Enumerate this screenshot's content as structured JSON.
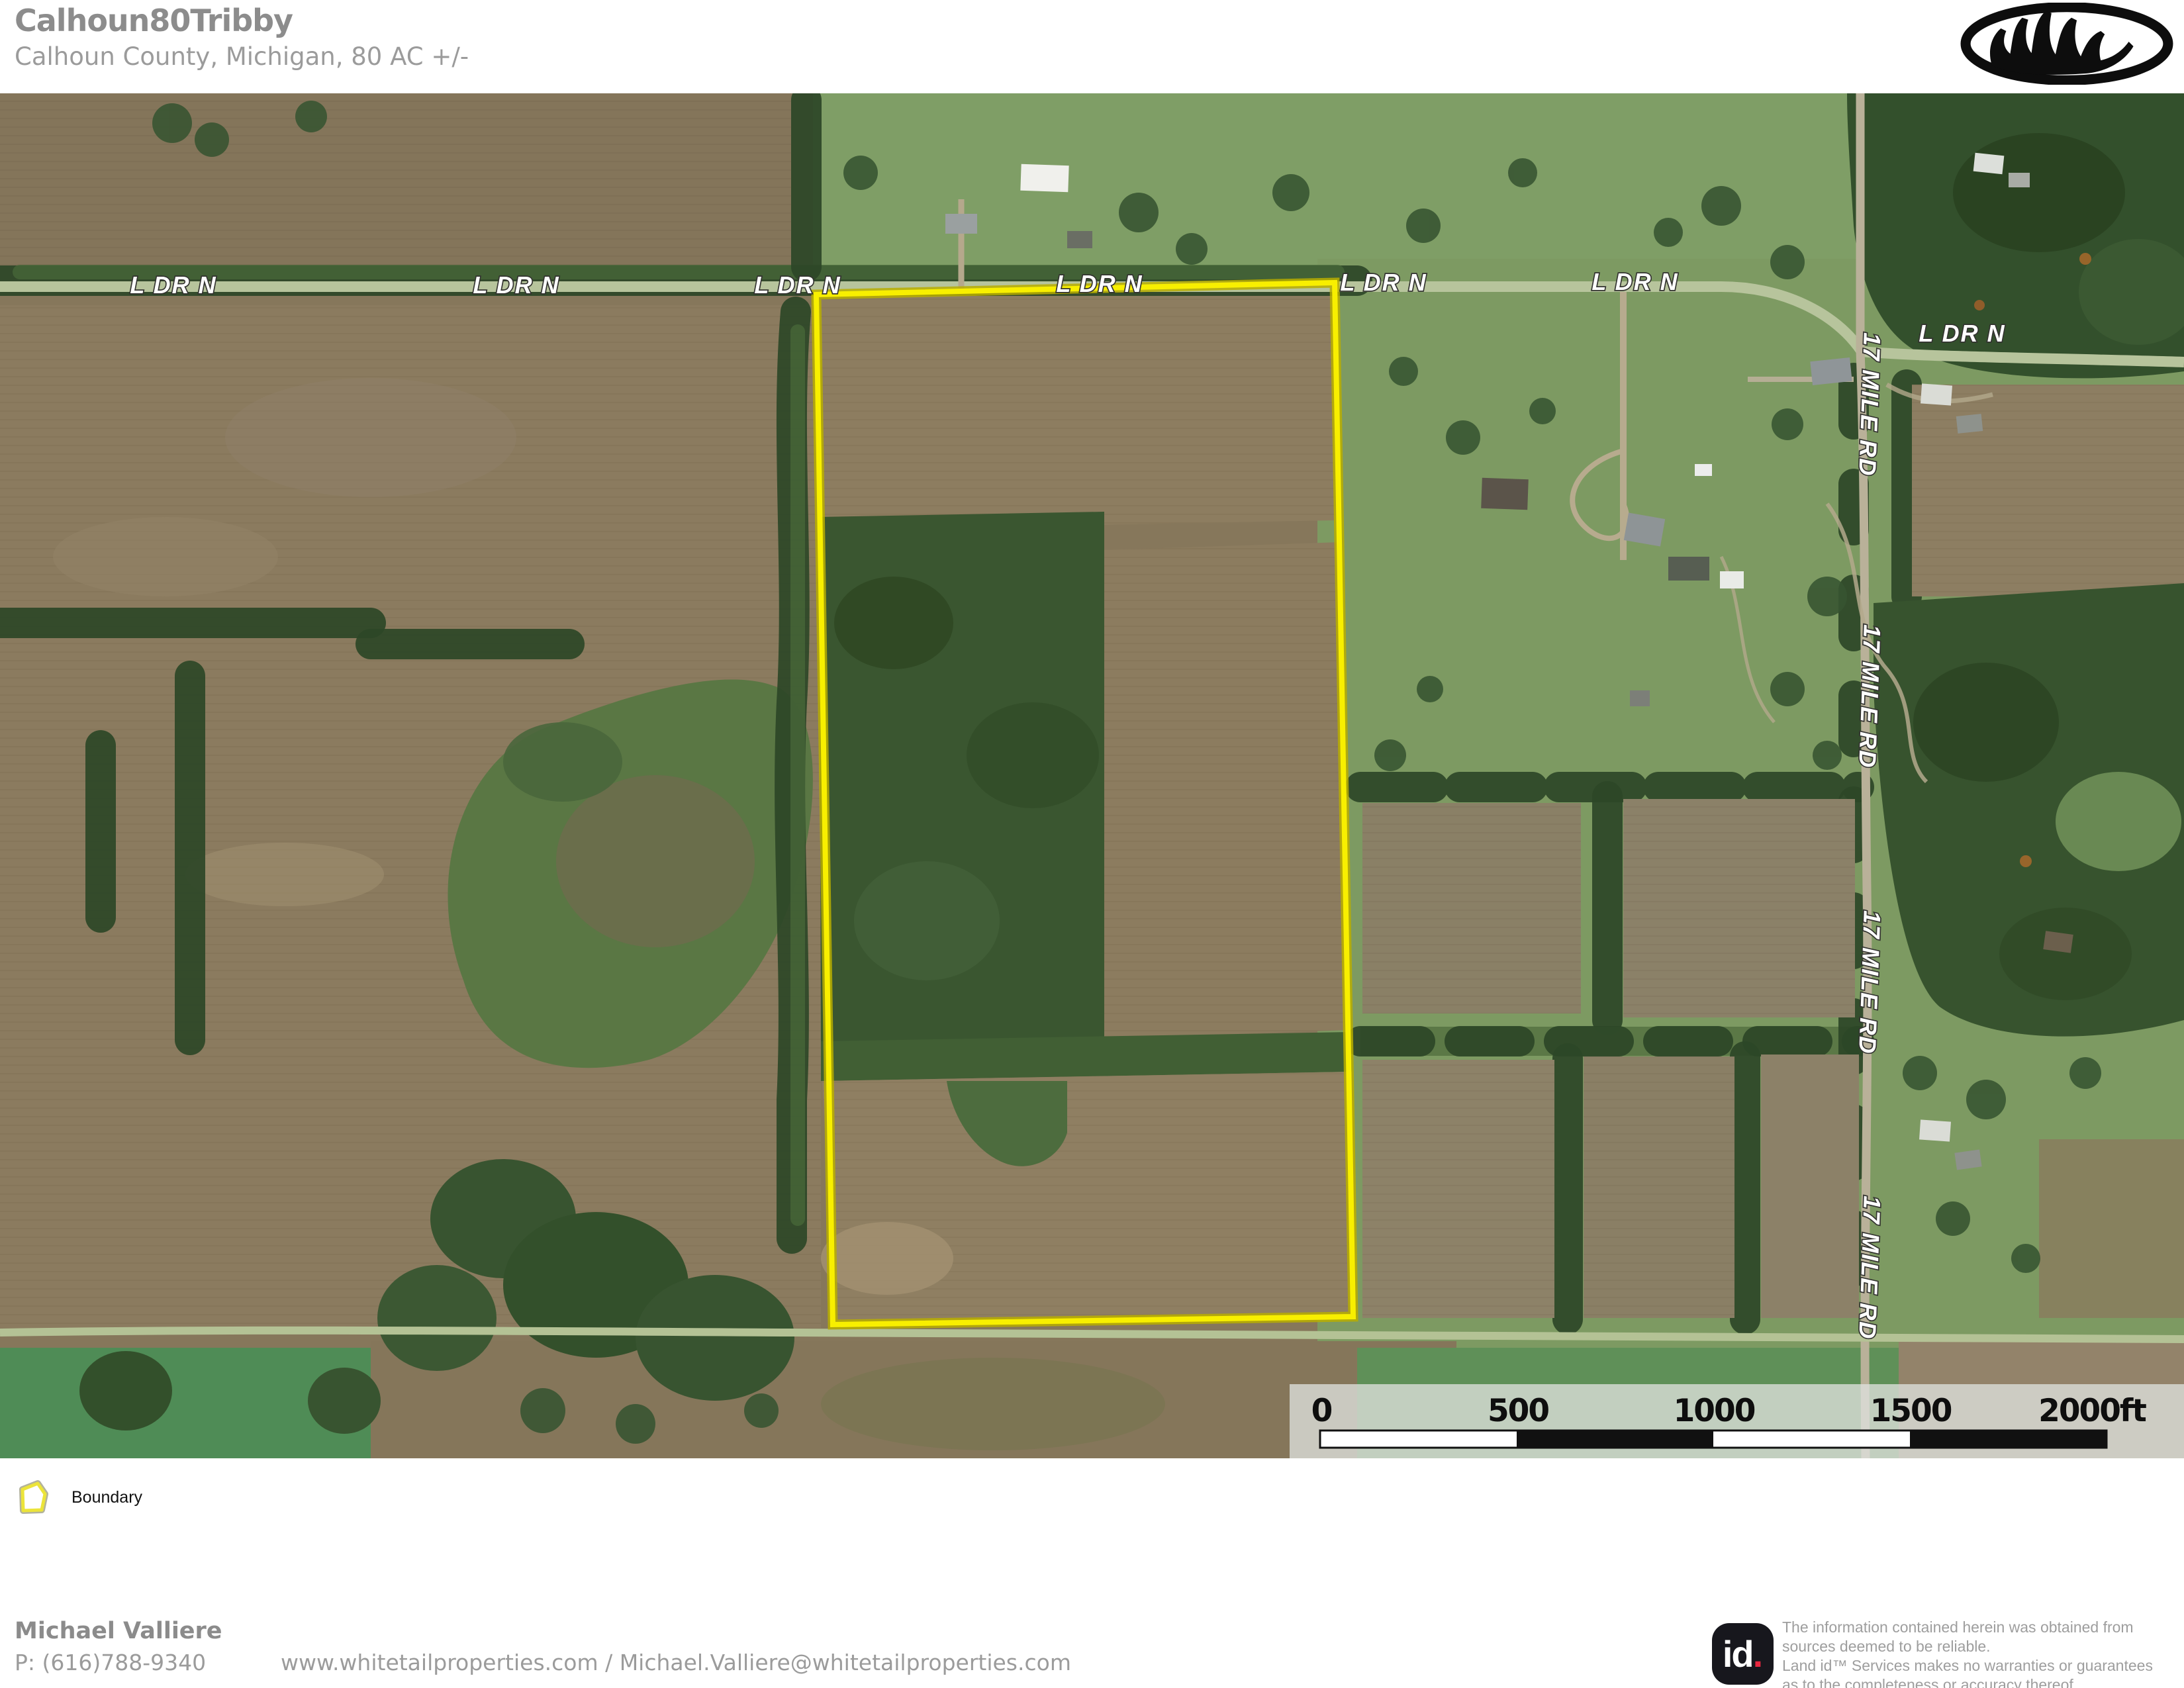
{
  "header": {
    "title": "Calhoun80Tribby",
    "subtitle": "Calhoun County, Michigan, 80 AC +/-",
    "brand_logo": "whitetail-properties-antler-logo"
  },
  "map": {
    "road_labels": {
      "l_dr_n": "L DR N",
      "mile_17": "17 MILE RD"
    },
    "boundary_color": "#F8EF00",
    "acreage": "80 AC +/-",
    "scale_bar": {
      "ticks": [
        "0",
        "500",
        "1000",
        "1500",
        "2000ft"
      ]
    }
  },
  "legend": {
    "boundary_label": "Boundary",
    "boundary_color": "#F8EF00"
  },
  "footer": {
    "agent_name": "Michael Valliere",
    "agent_phone": "P: (616)788-9340",
    "agent_contact": "www.whitetailproperties.com / Michael.Valliere@whitetailproperties.com",
    "disclaimer_lines": [
      "The information contained herein was obtained from",
      "sources deemed to be reliable.",
      " Land id™ Services makes no warranties or guarantees",
      "as to the completeness or accuracy thereof."
    ],
    "landid_text": "id",
    "landid_colors": {
      "bg": "#17171d",
      "dot": "#e8273f"
    }
  }
}
